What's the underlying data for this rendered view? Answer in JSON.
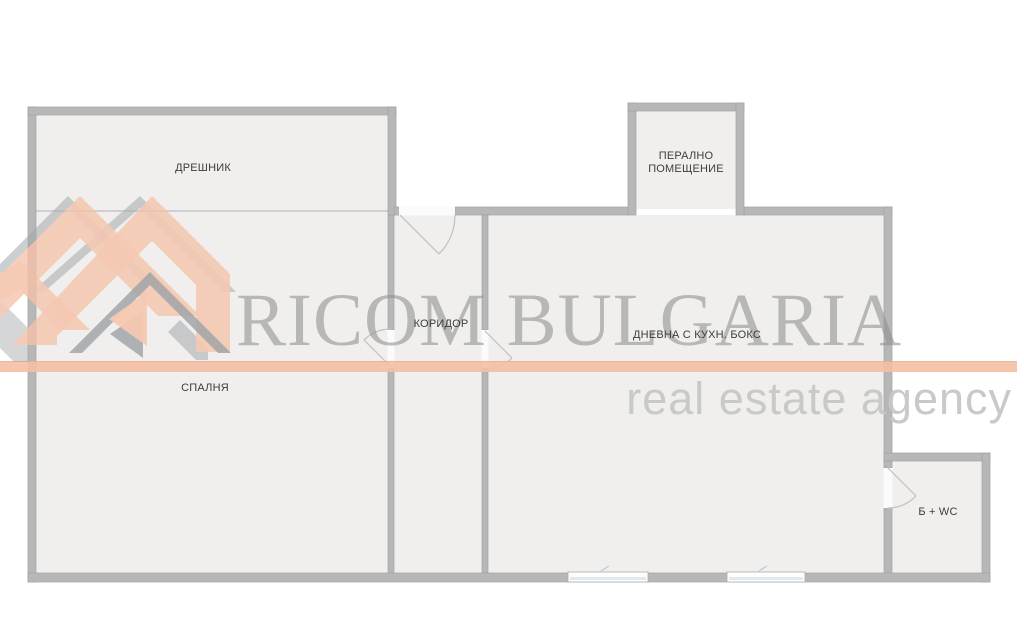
{
  "watermark": {
    "brand": "RICOM BULGARIA",
    "tagline": "real estate agency"
  },
  "rooms": {
    "dressing": "ДРЕШНИК",
    "bedroom": "СПАЛНЯ",
    "corridor": "КОРИДОР",
    "living": "ДНЕВНА С КУХН. БОКС",
    "laundry": "ПЕРАЛНО ПОМЕЩЕНИЕ",
    "bath": "Б + WC"
  },
  "colors": {
    "wall_gray": "#b7b7b7",
    "room_fill": "#f0efee",
    "accent_salmon": "#f5c2a8",
    "logo_gray": "#a3a7aa",
    "watermark_text_gray": "#8f8f8f",
    "tagline_gray": "#c7c7c7",
    "window_blue": "#dfeaf2"
  }
}
